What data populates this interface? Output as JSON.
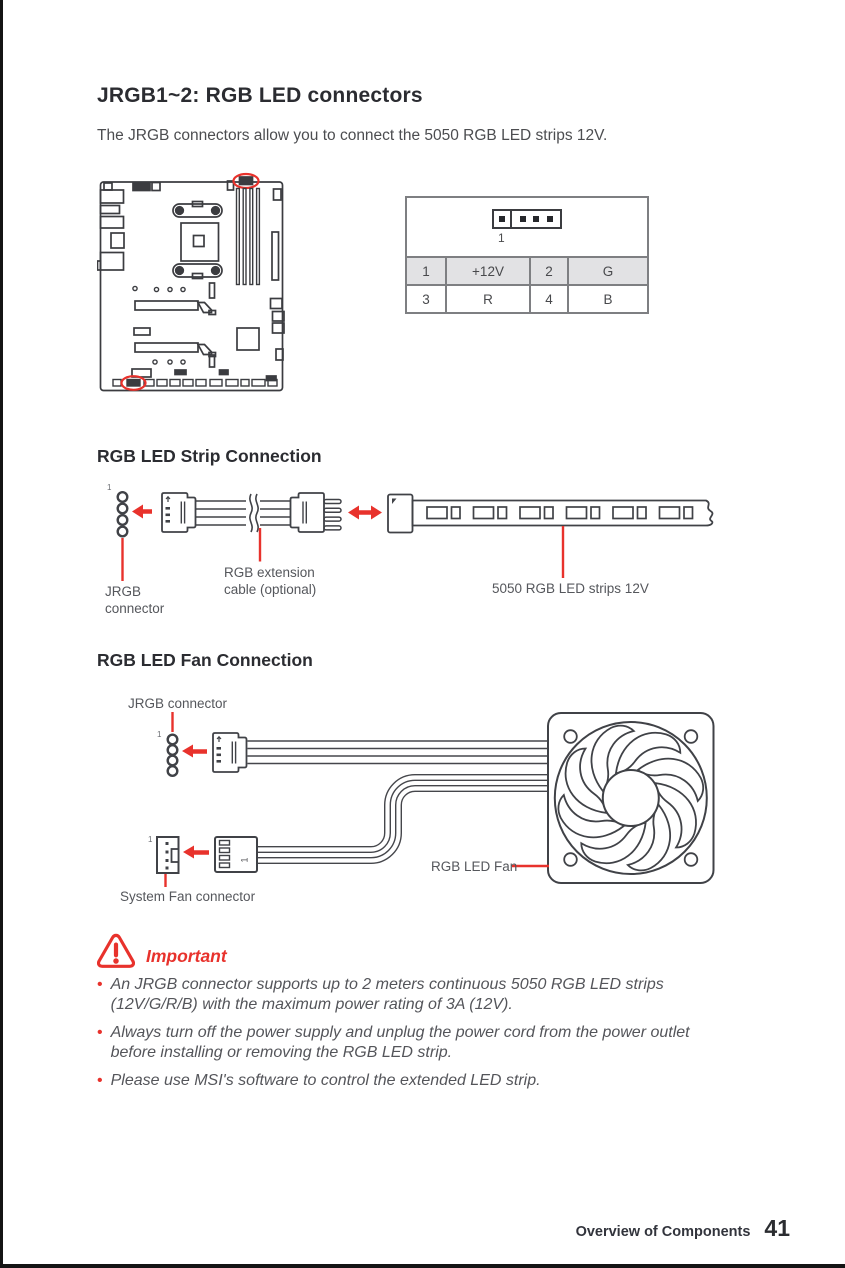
{
  "page": {
    "title": "JRGB1~2: RGB LED connectors",
    "intro": "The JRGB connectors allow you to connect the 5050 RGB LED strips 12V.",
    "footer_section": "Overview of Components",
    "footer_page": "41"
  },
  "colors": {
    "accent_red": "#e8322c",
    "ink": "#2b2c31",
    "body_text": "#4c4d50",
    "diagram_line": "#404247"
  },
  "pin_table": {
    "pin_marker": "1",
    "rows": [
      [
        "1",
        "+12V",
        "2",
        "G"
      ],
      [
        "3",
        "R",
        "4",
        "B"
      ]
    ]
  },
  "strip_section": {
    "heading": "RGB LED Strip Connection",
    "pin1": "1",
    "label_jrgb_line1": "JRGB",
    "label_jrgb_line2": "connector",
    "label_ext_line1": "RGB extension",
    "label_ext_line2": "cable (optional)",
    "label_strip": "5050 RGB LED strips 12V"
  },
  "fan_section": {
    "heading": "RGB LED Fan Connection",
    "pin1_jrgb": "1",
    "pin1_sysfan": "1",
    "pin1_plug": "1",
    "label_jrgb": "JRGB connector",
    "label_sysfan": "System Fan connector",
    "label_fan": "RGB LED Fan"
  },
  "important": {
    "heading": "Important",
    "bullets": [
      "An JRGB connector supports up to 2 meters continuous 5050 RGB LED strips (12V/G/R/B) with the maximum power rating of 3A (12V).",
      "Always turn off the power supply and unplug the power cord from the power outlet before installing or removing the RGB LED strip.",
      "Please use MSI's software to control the extended LED strip."
    ]
  }
}
